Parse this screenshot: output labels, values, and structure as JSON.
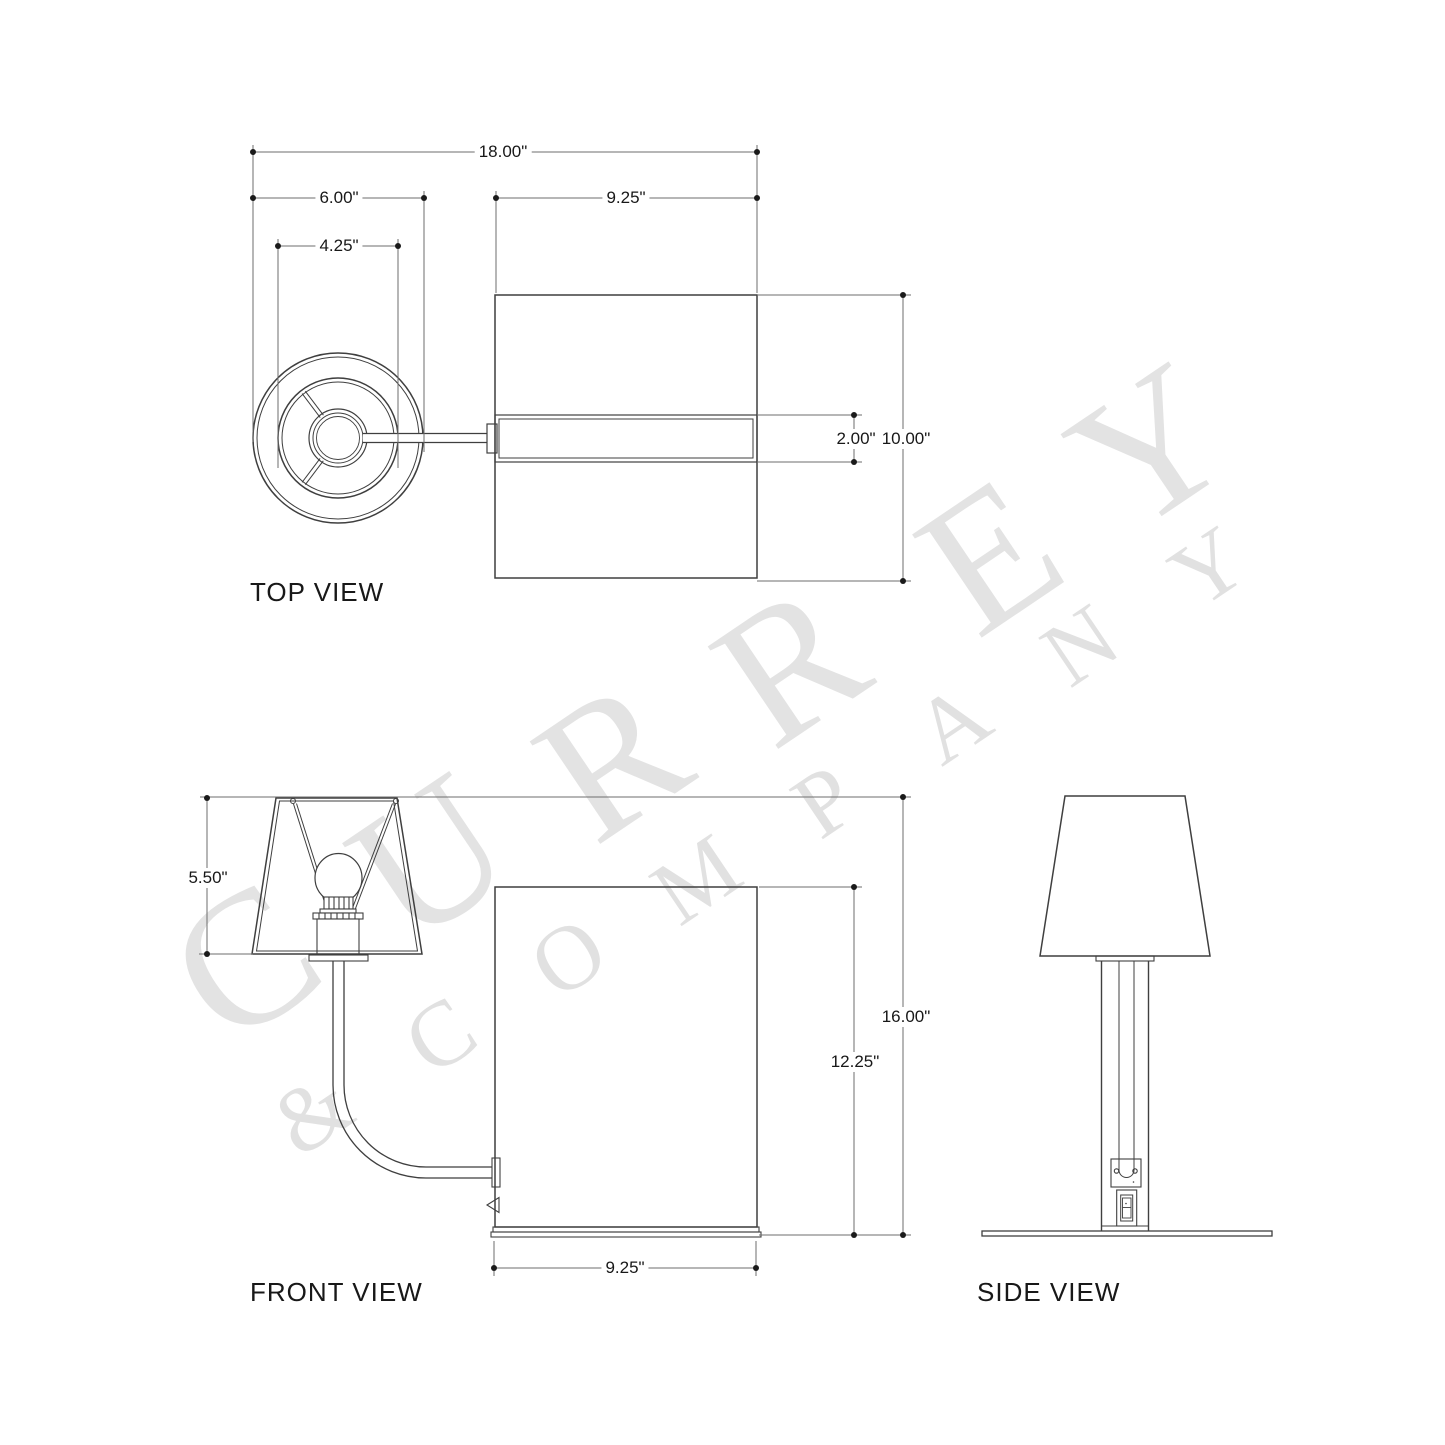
{
  "views": {
    "top_label": "TOP VIEW",
    "front_label": "FRONT VIEW",
    "side_label": "SIDE VIEW"
  },
  "dims": {
    "top": {
      "overall_width": "18.00\"",
      "shade_offset_width": "6.00\"",
      "shade_ring_diameter": "4.25\"",
      "box_width": "9.25\"",
      "slot_height": "2.00\"",
      "box_depth": "10.00\""
    },
    "front": {
      "shade_height": "5.50\"",
      "box_height": "12.25\"",
      "overall_height": "16.00\"",
      "box_width": "9.25\""
    }
  },
  "watermark": {
    "big_letters": [
      "C",
      "U",
      "R",
      "R",
      "E",
      "Y"
    ],
    "small_letters": [
      "&",
      "C",
      "O",
      "M",
      "P",
      "A",
      "N",
      "Y"
    ],
    "color_big": "#e3e3e3",
    "color_small": "#e1e1e1"
  },
  "colors": {
    "line": "#3f3f3f",
    "dim_line": "#6e6e6e",
    "text": "#181818",
    "background": "#ffffff"
  }
}
